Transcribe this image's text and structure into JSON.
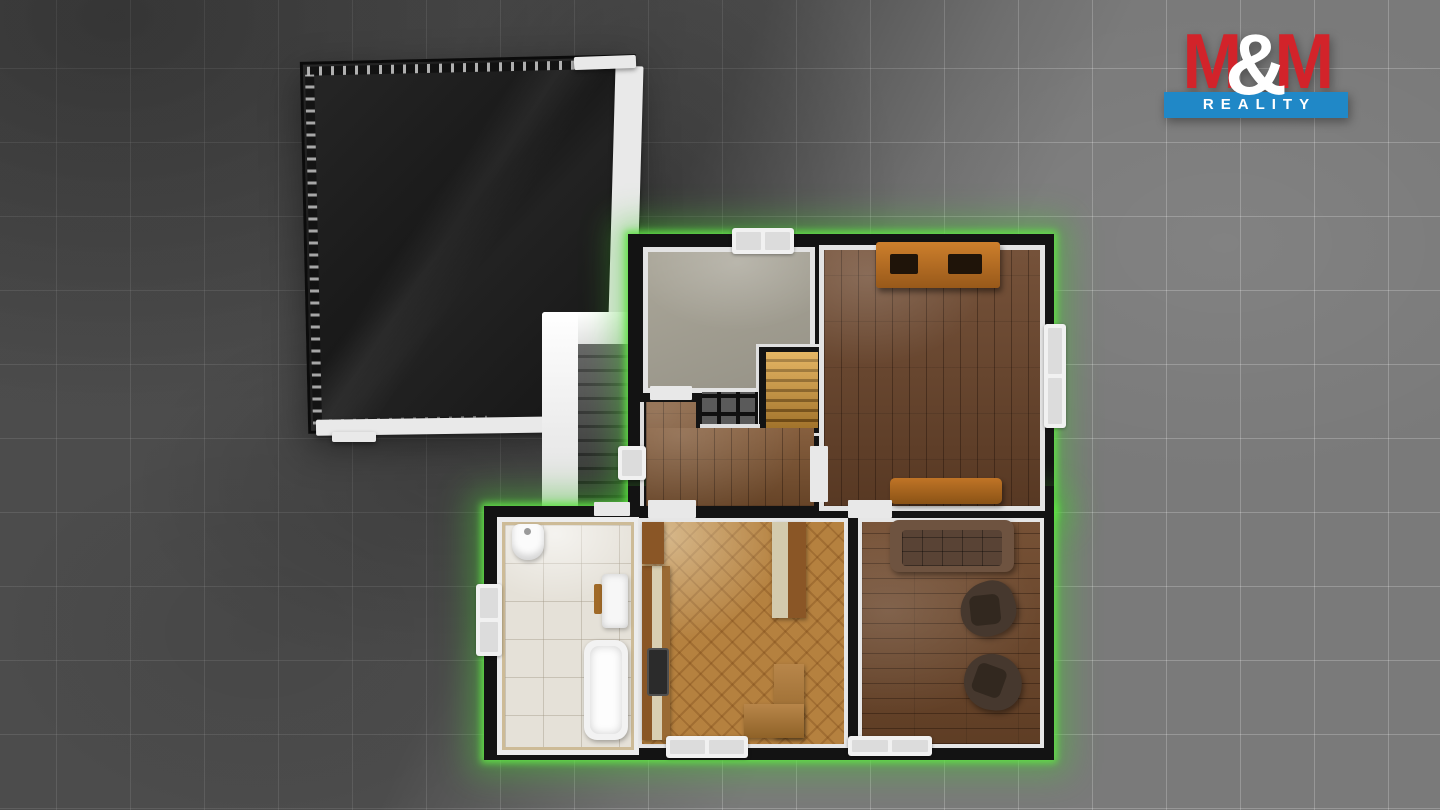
{
  "logo": {
    "m_left": "M",
    "ampersand": "&",
    "m_right": "M",
    "banner": "REALITY"
  },
  "palette": {
    "bg_tile": "#7a7a7a",
    "wall": "#131313",
    "glow_green": "#3ec23a",
    "trim_white": "#ececec",
    "roof": "#1e1e1e",
    "floor_study": "#b3afa1",
    "floor_hall": "#7d5330",
    "floor_bedroom": "#6b452b",
    "floor_kitchen": "#b5813f",
    "floor_living": "#6f482b",
    "floor_bath": "#e5e1d8",
    "wood_accent": "#b06020",
    "stairs_amber": "#c88a2e",
    "stairs_outdoor": "#3c3c3c",
    "logo_red": "#d2232a",
    "logo_blue": "#2088c7"
  }
}
